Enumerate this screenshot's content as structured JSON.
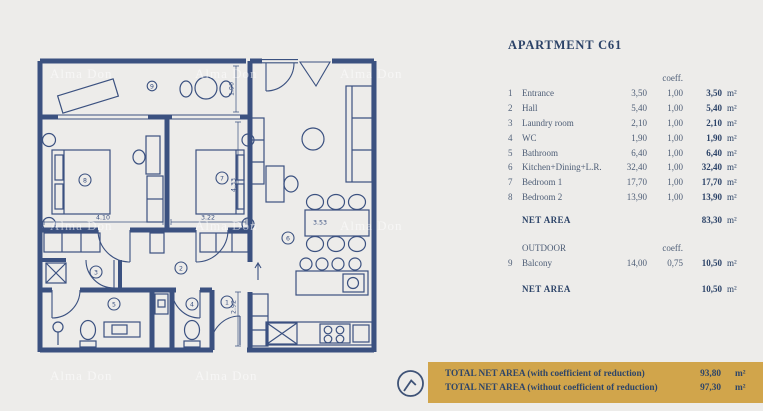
{
  "title": "APARTMENT C61",
  "table": {
    "coeff_header": "coeff.",
    "rows": [
      {
        "num": "1",
        "name": "Entrance",
        "area": "3,50",
        "coeff": "1,00",
        "total": "3,50",
        "unit": "m²"
      },
      {
        "num": "2",
        "name": "Hall",
        "area": "5,40",
        "coeff": "1,00",
        "total": "5,40",
        "unit": "m²"
      },
      {
        "num": "3",
        "name": "Laundry room",
        "area": "2,10",
        "coeff": "1,00",
        "total": "2,10",
        "unit": "m²"
      },
      {
        "num": "4",
        "name": "WC",
        "area": "1,90",
        "coeff": "1,00",
        "total": "1,90",
        "unit": "m²"
      },
      {
        "num": "5",
        "name": "Bathroom",
        "area": "6,40",
        "coeff": "1,00",
        "total": "6,40",
        "unit": "m²"
      },
      {
        "num": "6",
        "name": "Kitchen+Dining+L.R.",
        "area": "32,40",
        "coeff": "1,00",
        "total": "32,40",
        "unit": "m²"
      },
      {
        "num": "7",
        "name": "Bedroom 1",
        "area": "17,70",
        "coeff": "1,00",
        "total": "17,70",
        "unit": "m²"
      },
      {
        "num": "8",
        "name": "Bedroom 2",
        "area": "13,90",
        "coeff": "1,00",
        "total": "13,90",
        "unit": "m²"
      }
    ],
    "net_area": {
      "label": "NET AREA",
      "value": "83,30",
      "unit": "m²"
    },
    "outdoor": {
      "label": "OUTDOOR",
      "coeff_header": "coeff.",
      "rows": [
        {
          "num": "9",
          "name": "Balcony",
          "area": "14,00",
          "coeff": "0,75",
          "total": "10,50",
          "unit": "m²"
        }
      ],
      "net_area": {
        "label": "NET AREA",
        "value": "10,50",
        "unit": "m²"
      }
    }
  },
  "banner": {
    "line1": {
      "label": "TOTAL NET AREA (with coefficient of reduction)",
      "value": "93,80",
      "unit": "m²"
    },
    "line2": {
      "label": "TOTAL NET AREA (without coefficient of reduction)",
      "value": "97,30",
      "unit": "m²"
    },
    "background": "#d1a54b",
    "text_color": "#2e4568"
  },
  "plan": {
    "rooms": {
      "r1": "1",
      "r2": "2",
      "r3": "3",
      "r4": "4",
      "r5": "5",
      "r6": "6",
      "r7": "7",
      "r8": "8",
      "r9": "9"
    },
    "dims": {
      "balcony_depth": "1.90",
      "bedroom2_width": "4.10",
      "bedroom1_width": "3.22",
      "bedroom1_depth": "4.33",
      "dining_width": "3.53",
      "entrance_depth": "2.92"
    },
    "line_color": "#3b5180"
  },
  "watermark": {
    "text": "Alma Don"
  },
  "page": {
    "background": "#edecea"
  }
}
